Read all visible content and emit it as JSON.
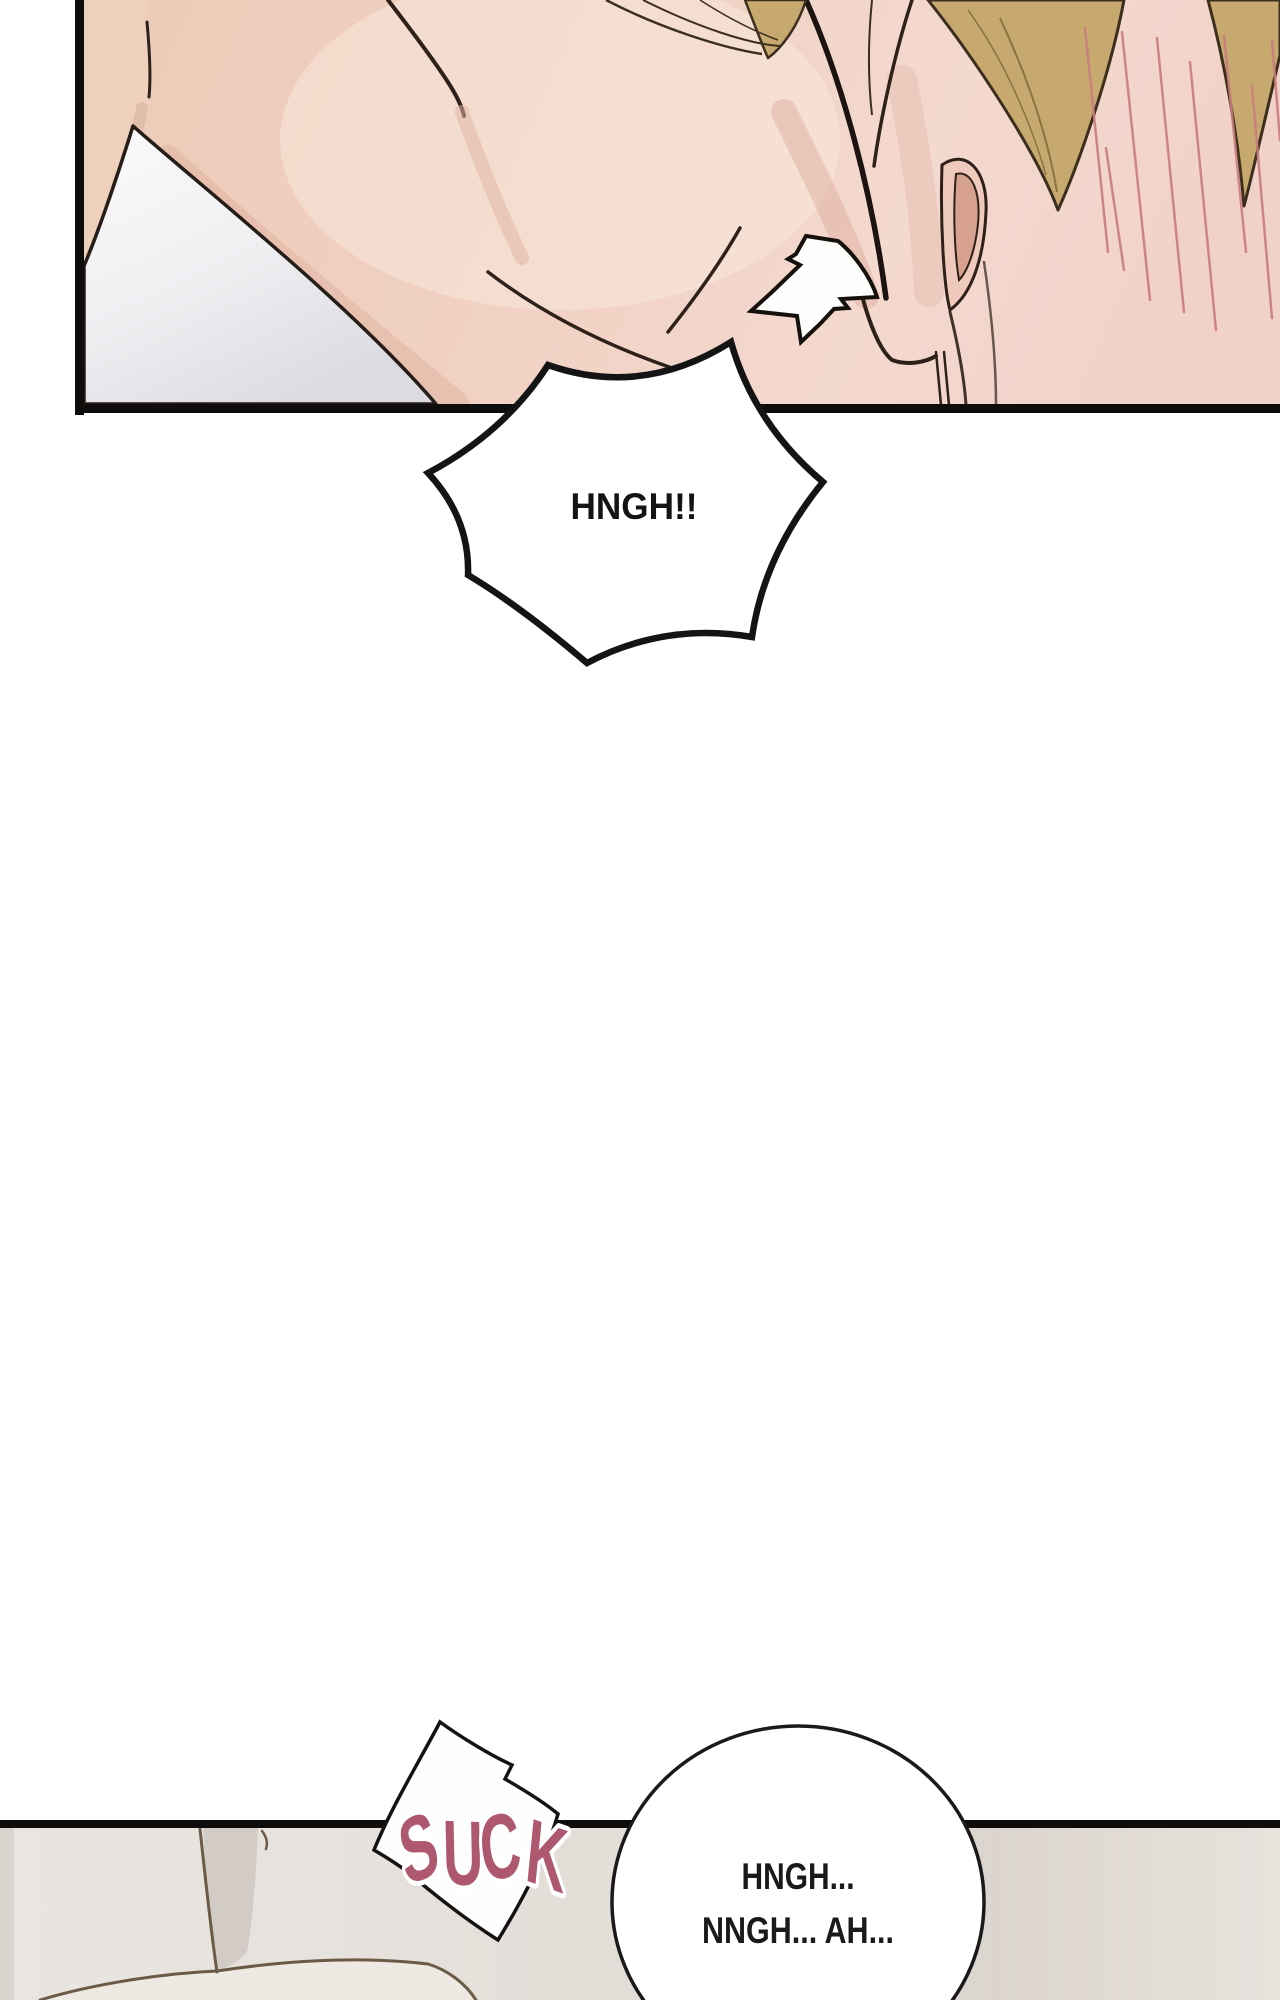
{
  "page": {
    "width": 1280,
    "height": 2000,
    "background": "#ffffff"
  },
  "top_panel": {
    "border_color": "#0e0d0c",
    "colors": {
      "skin": "#f0cfc1",
      "skin_left": "#eed0bd",
      "skin_shadow": "#ddae9b",
      "fabric_white": "#f9f8fa",
      "fabric_shadow": "#dcdbdf",
      "hair": "#c7a86e",
      "hair_line": "#3c2f1d",
      "blush": "#c97d7d",
      "ink": "#2e2119",
      "ear_inner": "#d7a18f"
    }
  },
  "shout_bubble": {
    "text": "HNGH!!",
    "fill": "#ffffff",
    "line_color": "#141414"
  },
  "sfx": {
    "text": "SUCK",
    "color": "#ae5870",
    "outline": "#ffffff"
  },
  "bottom_panel": {
    "border_color": "#0e0d0c",
    "colors": {
      "bedding": "#e7e2dd",
      "bedding_light": "#ebe7e3",
      "bedding_shadow": "#d3ccc6",
      "fold_line": "#6b5b46"
    }
  },
  "speech_bubble": {
    "lines": [
      "HNGH...",
      "NNGH... AH..."
    ],
    "fill": "#ffffff",
    "line_color": "#1a1a1a"
  }
}
